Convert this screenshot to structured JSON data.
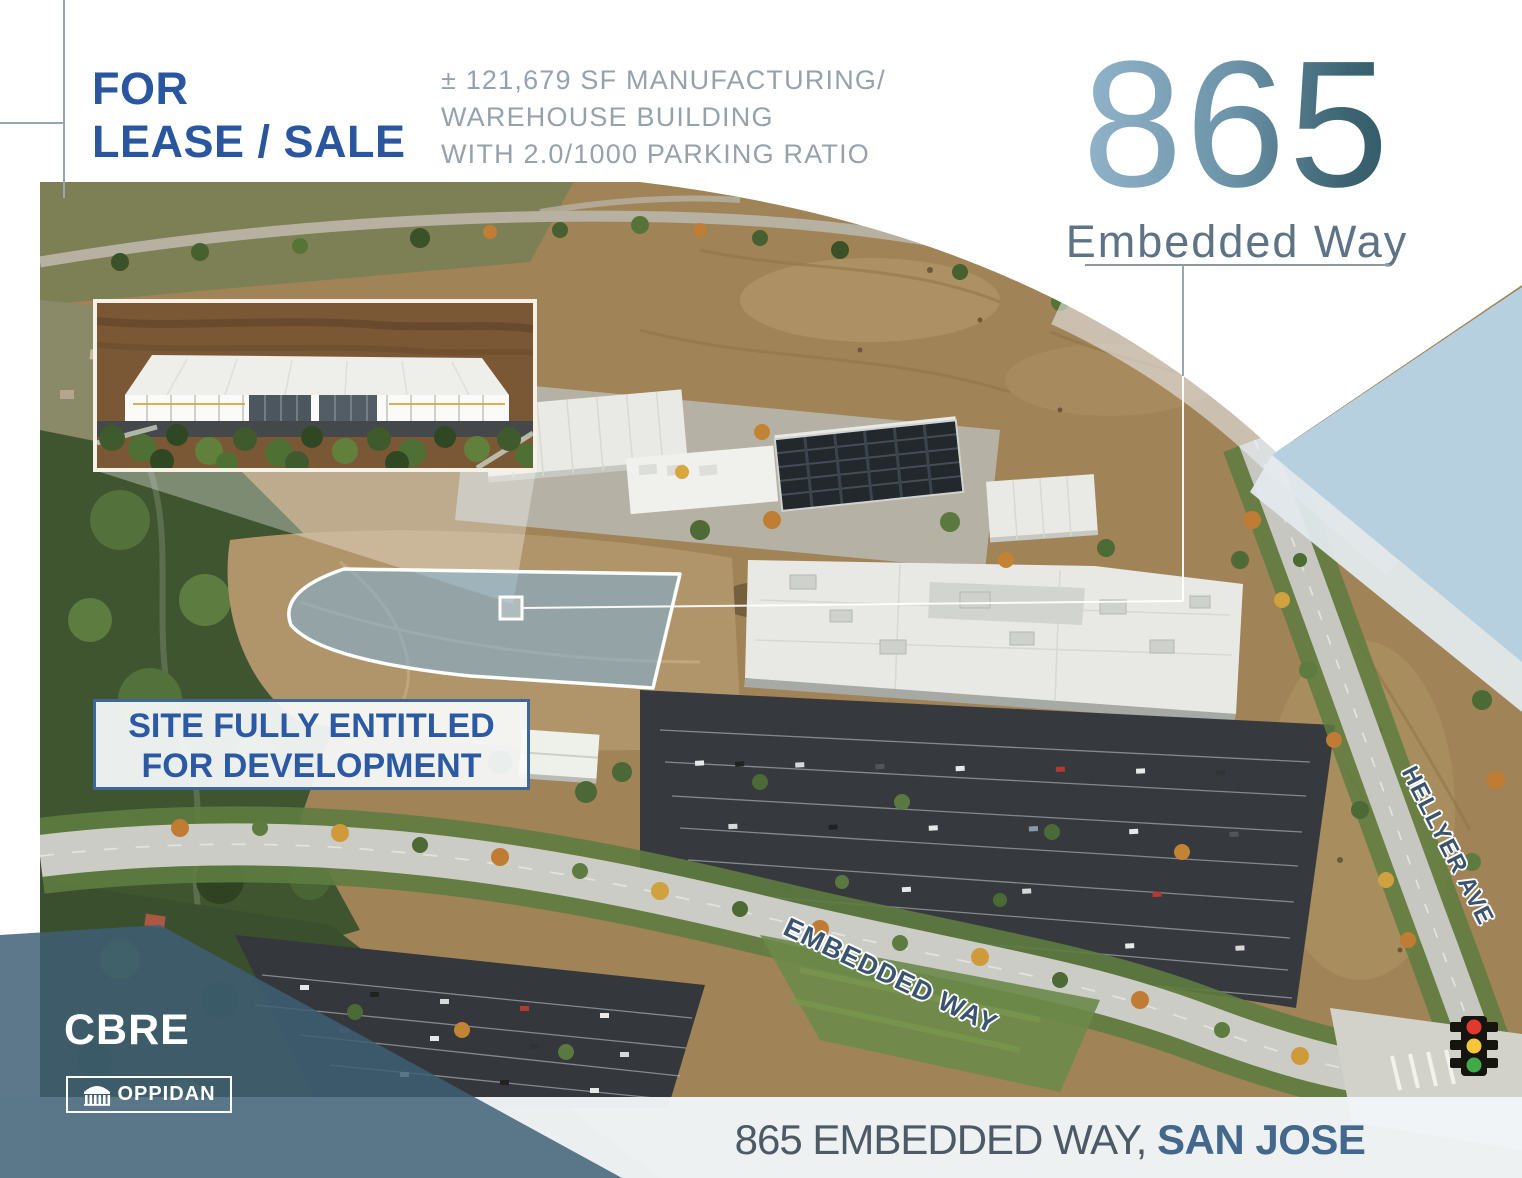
{
  "header": {
    "listing_type_line1": "FOR",
    "listing_type_line2": "LEASE / SALE",
    "specs_line1": "± 121,679 SF MANUFACTURING/",
    "specs_line2": "WAREHOUSE BUILDING",
    "specs_line3": "WITH 2.0/1000 PARKING RATIO"
  },
  "title": {
    "number": "865",
    "street": "Embedded Way"
  },
  "site_banner": {
    "line1": "SITE FULLY ENTITLED",
    "line2": "FOR DEVELOPMENT"
  },
  "map_labels": {
    "embedded_way": "EMBEDDED WAY",
    "hellyer_ave": "HELLYER AVE"
  },
  "footer": {
    "address_regular": "865 EMBEDDED WAY, ",
    "address_bold": "SAN JOSE"
  },
  "brands": {
    "cbre": "CBRE",
    "oppidan": "OPPIDAN"
  },
  "icons": {
    "traffic_light": "traffic-light-icon",
    "oppidan_columns": "columns-building-icon"
  },
  "colors": {
    "primary_blue": "#2a56a0",
    "muted_gray": "#96a2ab",
    "title_gradient_start": "#9cbcd4",
    "title_gradient_end": "#2e5560",
    "slate_footer": "#44678c",
    "pale_blue_triangle": "#b7d0e0",
    "corner_wedge": "#3e5e75",
    "site_outline_fill": "#7fb0d3"
  }
}
